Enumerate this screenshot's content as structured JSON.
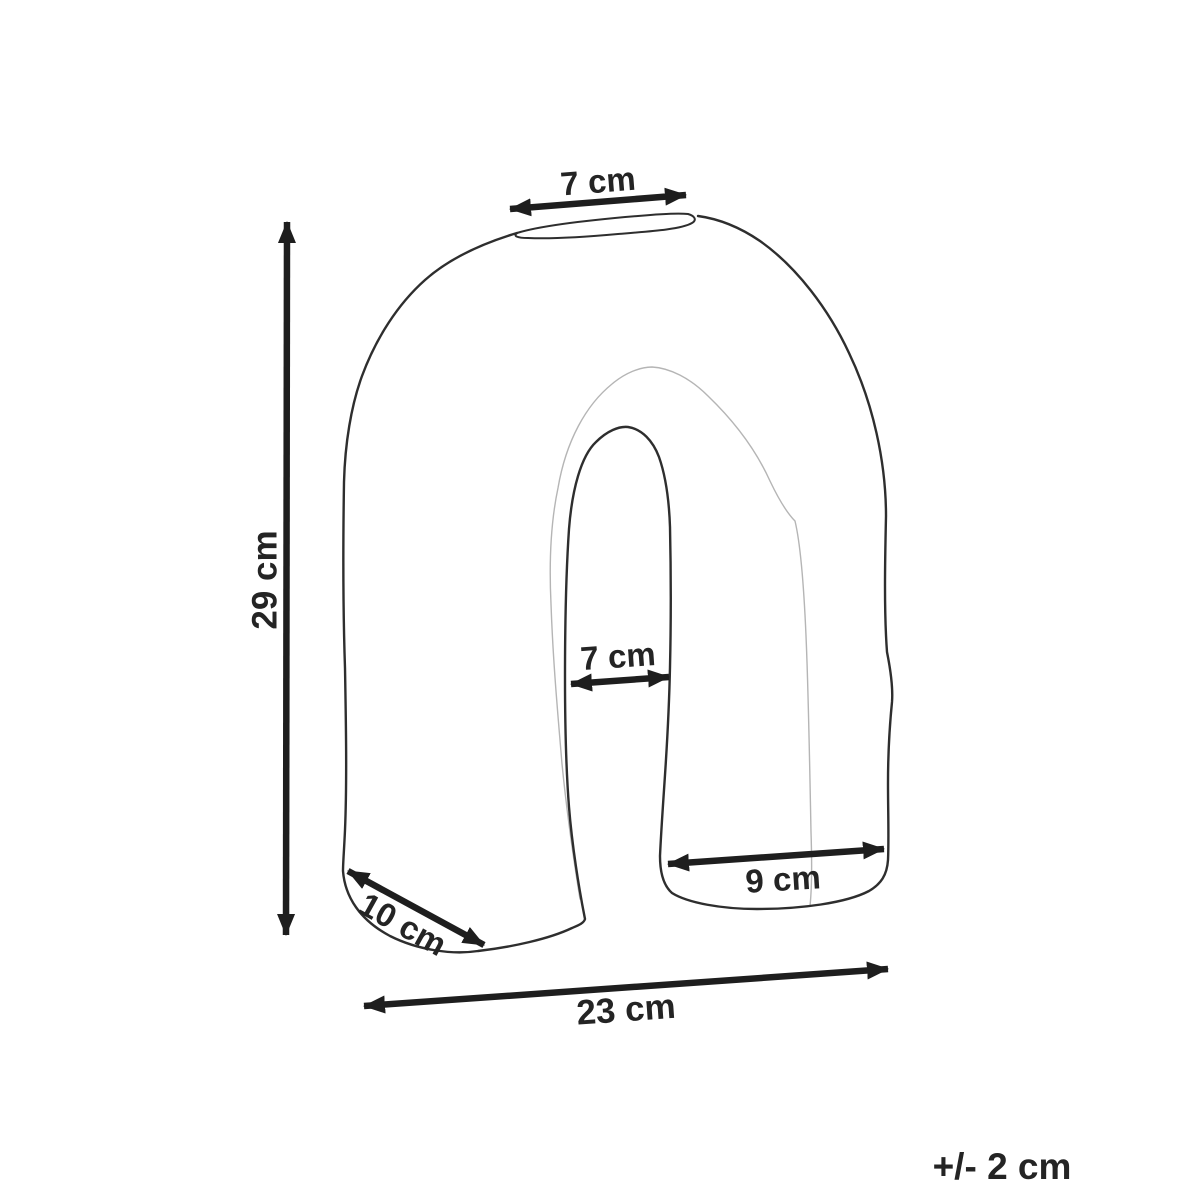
{
  "figure": {
    "type": "product-dimension-diagram",
    "subject": "arch-shaped vase",
    "units": "cm"
  },
  "dimensions": {
    "top_opening_width": "7 cm",
    "overall_height": "29 cm",
    "inner_arch_width": "7 cm",
    "right_base_width": "9 cm",
    "left_base_depth": "10 cm",
    "overall_width": "23 cm"
  },
  "tolerance_note": "+/- 2 cm",
  "colors": {
    "background": "#ffffff",
    "outline": "#2e2e2e",
    "depth_line": "#b5b5b5",
    "dimension": "#1e1e1e",
    "text": "#242424"
  }
}
